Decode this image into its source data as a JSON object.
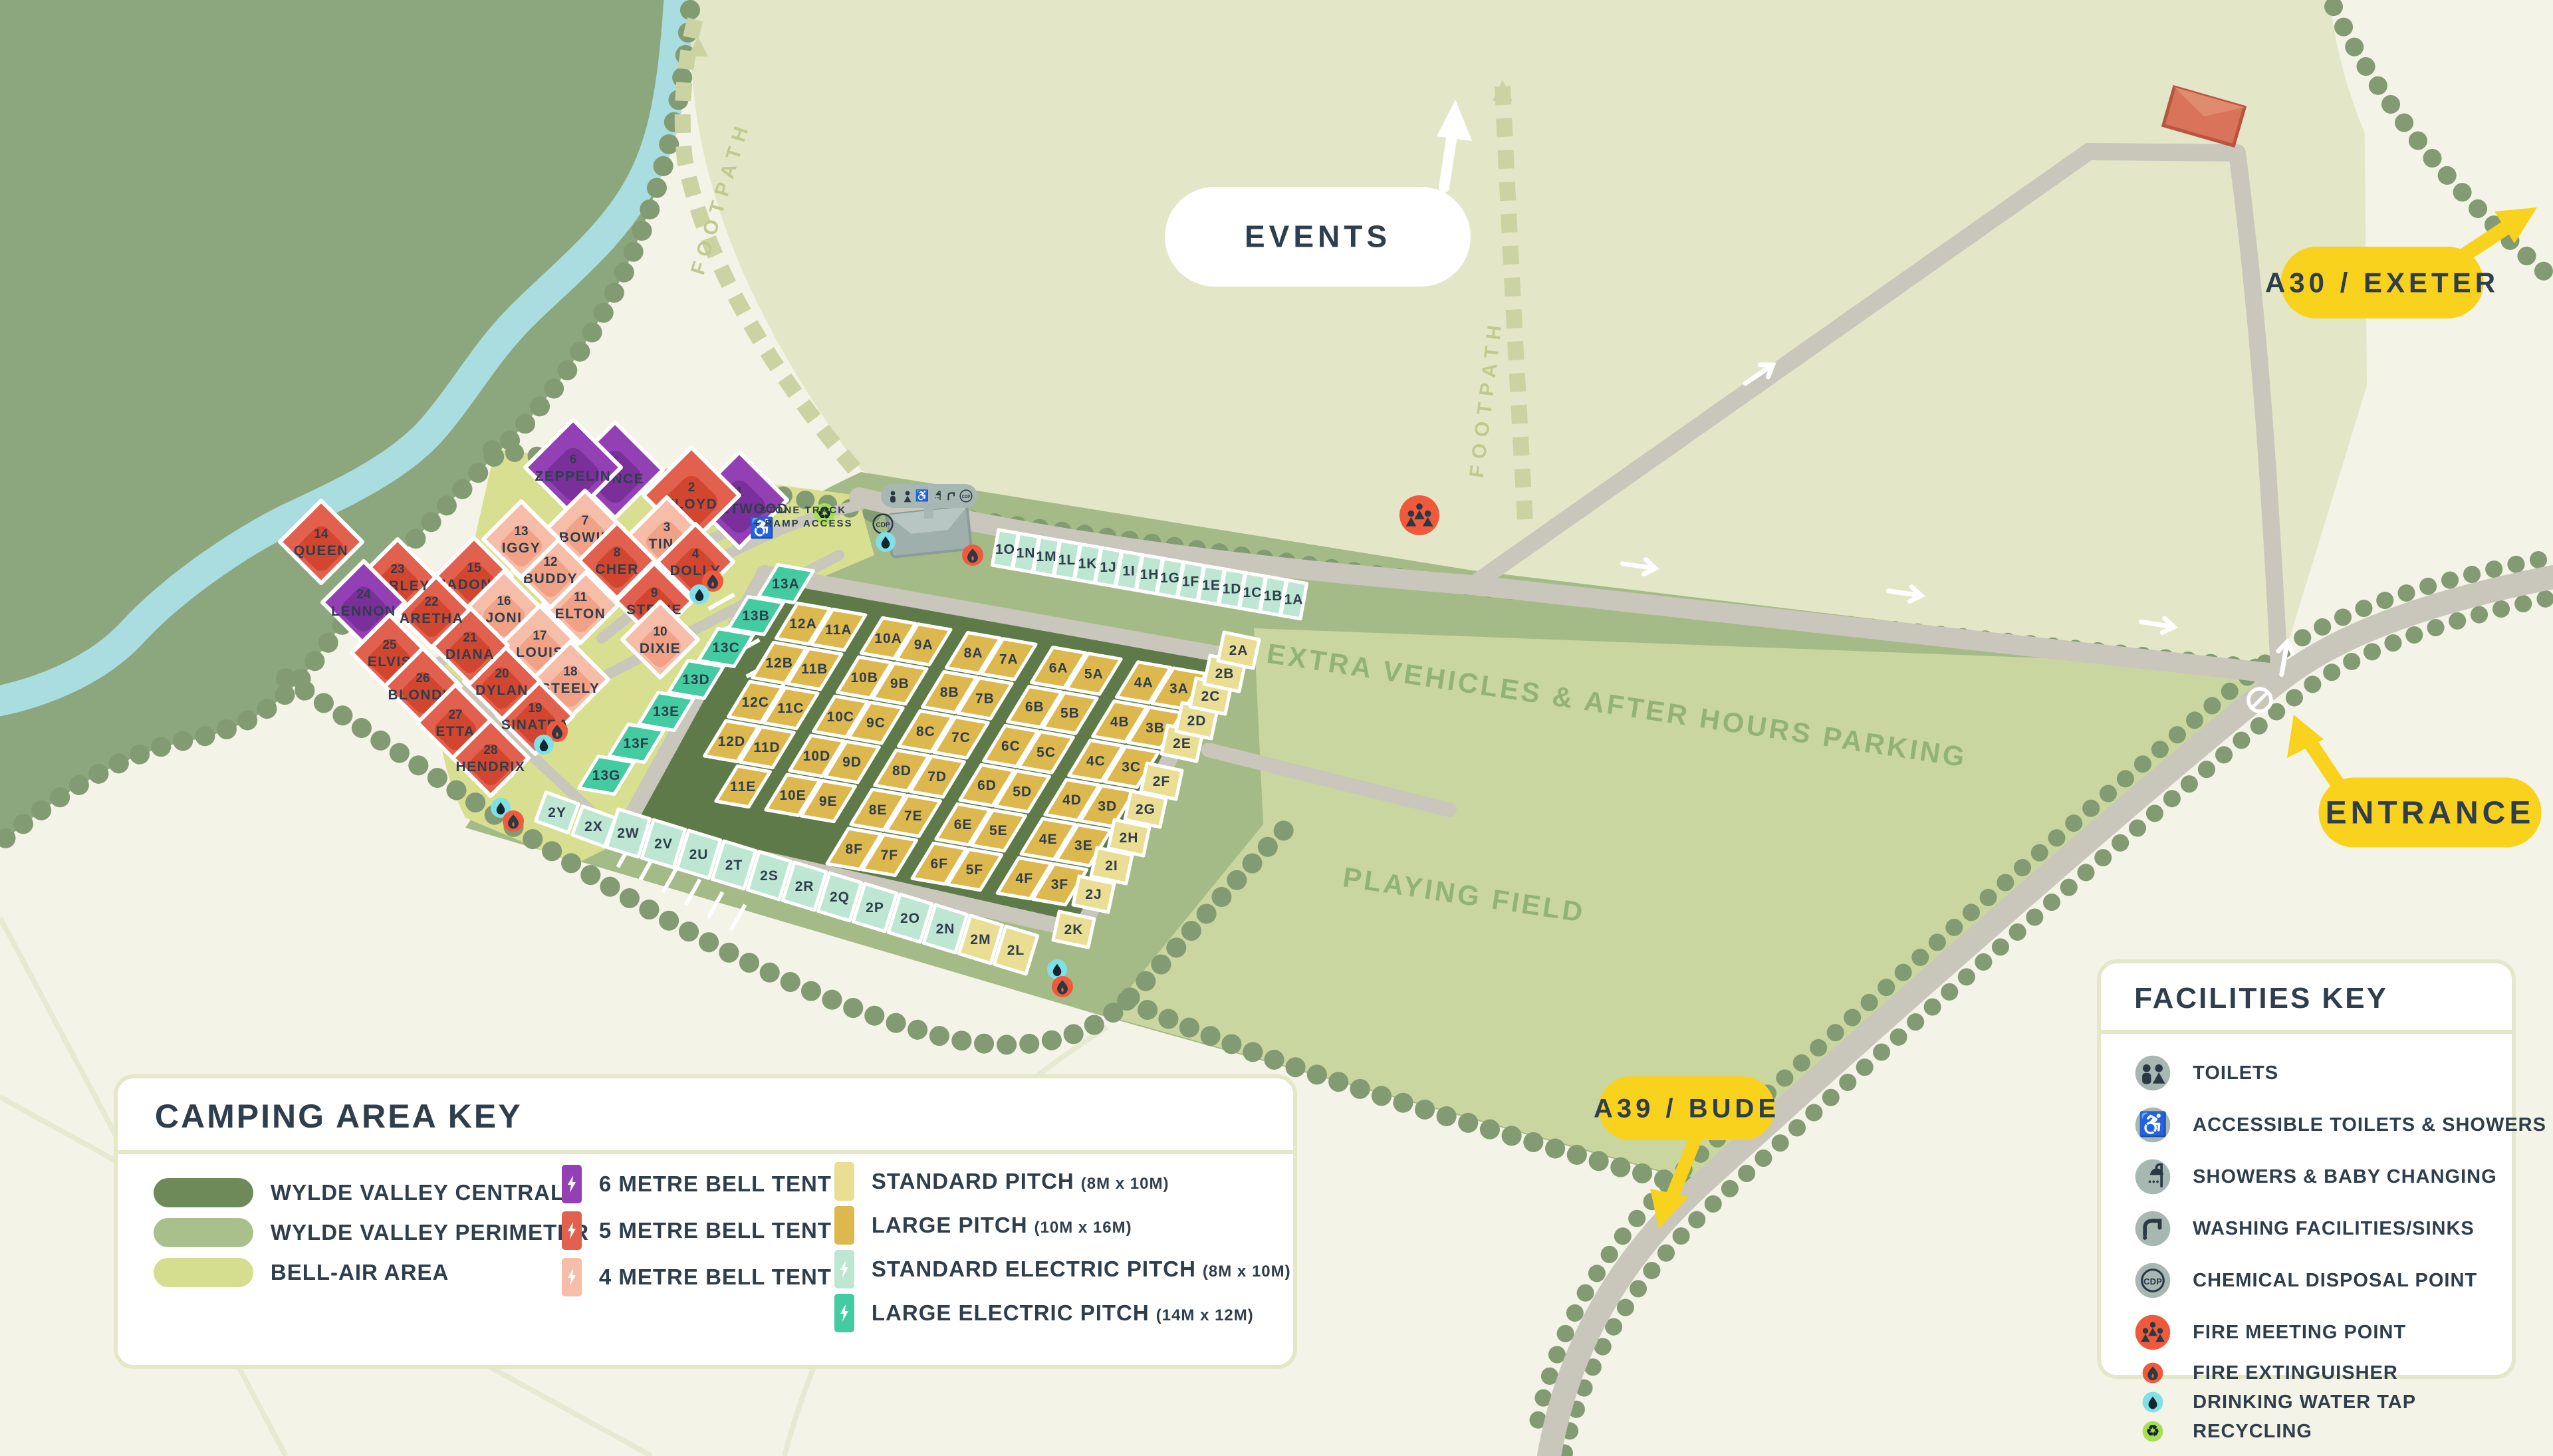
{
  "palette": {
    "cream": "#F4F3E7",
    "woodland": "#8CA77D",
    "events_field": "#E3E7C7",
    "perimeter": "#A4BB87",
    "playing": "#C9D6A0",
    "bellair": "#D9DF90",
    "central": "#5E7A48",
    "river": "#A9DDE0",
    "road": "#C9C6BB",
    "hedge": "#839B72",
    "navy": "#2F3E4C",
    "badge_yellow": "#F8D21C",
    "tent6": "#9440B5",
    "tent5": "#E2614E",
    "tent4": "#F6BDA9",
    "std": "#E9DE93",
    "large": "#DDB84E",
    "std_electric": "#BDE7D2",
    "large_electric": "#44CBA1",
    "fire": "#F05A3C",
    "water": "#7FE0E8",
    "recycle": "#A8DF52",
    "facility_gray": "#A7B7B2",
    "footpath": "#CBD3A2",
    "green_text": "#93B375"
  },
  "badges": {
    "events": {
      "label": "EVENTS"
    },
    "a30": {
      "label": "A30 / EXETER"
    },
    "entrance": {
      "label": "ENTRANCE"
    },
    "a39": {
      "label": "A39 / BUDE"
    }
  },
  "field_labels": {
    "parking": "EXTRA VEHICLES & AFTER HOURS PARKING",
    "playing": "PLAYING FIELD",
    "footpath": "FOOTPATH",
    "stone_track_1": "STONE TRACK",
    "stone_track_2": "+ RAMP ACCESS"
  },
  "camping_key": {
    "title": "CAMPING AREA KEY",
    "areas": [
      {
        "label": "WYLDE VALLEY CENTRAL",
        "color": "#6F8A59"
      },
      {
        "label": "WYLDE VALLEY PERIMETER",
        "color": "#A9C08D"
      },
      {
        "label": "BELL-AIR AREA",
        "color": "#D5DD8E"
      }
    ],
    "tents": [
      {
        "label": "6 METRE BELL TENT",
        "color": "#9440B5",
        "bolt": true
      },
      {
        "label": "5 METRE BELL TENT",
        "color": "#E2614E",
        "bolt": true
      },
      {
        "label": "4 METRE BELL TENT",
        "color": "#F6BDA9",
        "bolt": true
      }
    ],
    "pitches": [
      {
        "label": "STANDARD PITCH",
        "dims": "(8M x 10M)",
        "color": "#E9DE93",
        "bolt": false
      },
      {
        "label": "LARGE PITCH",
        "dims": "(10M x 16M)",
        "color": "#DDB84E",
        "bolt": false
      },
      {
        "label": "STANDARD ELECTRIC PITCH",
        "dims": "(8M x 10M)",
        "color": "#BDE7D2",
        "bolt": true
      },
      {
        "label": "LARGE ELECTRIC PITCH",
        "dims": "(14M x 12M)",
        "color": "#44CBA1",
        "bolt": true
      }
    ]
  },
  "facilities_key": {
    "title": "FACILITIES KEY",
    "items": [
      {
        "icon": "toilets",
        "label": "TOILETS",
        "size": "big"
      },
      {
        "icon": "accessible",
        "label": "ACCESSIBLE TOILETS & SHOWERS",
        "size": "big"
      },
      {
        "icon": "shower",
        "label": "SHOWERS & BABY CHANGING",
        "size": "big"
      },
      {
        "icon": "tap",
        "label": "WASHING FACILITIES/SINKS",
        "size": "big"
      },
      {
        "icon": "cdp",
        "label": "CHEMICAL DISPOSAL POINT",
        "size": "big"
      },
      {
        "icon": "fire_meeting",
        "label": "FIRE MEETING POINT",
        "size": "big"
      },
      {
        "icon": "fire_ext",
        "label": "FIRE EXTINGUISHER",
        "size": "small"
      },
      {
        "icon": "water",
        "label": "DRINKING WATER TAP",
        "size": "small"
      },
      {
        "icon": "recycling",
        "label": "RECYCLING",
        "size": "small"
      }
    ]
  },
  "map": {
    "bell_tents": [
      {
        "num": "1",
        "name": "FLEETWOOD",
        "type": "6m",
        "accessible": true
      },
      {
        "num": "2",
        "name": "FLOYD",
        "type": "5m"
      },
      {
        "num": "3",
        "name": "TINA",
        "type": "4m"
      },
      {
        "num": "4",
        "name": "DOLLY",
        "type": "5m"
      },
      {
        "num": "5",
        "name": "PRINCE",
        "type": "6m"
      },
      {
        "num": "6",
        "name": "ZEPPELIN",
        "type": "6m"
      },
      {
        "num": "7",
        "name": "BOWIE",
        "type": "4m"
      },
      {
        "num": "8",
        "name": "CHER",
        "type": "5m"
      },
      {
        "num": "9",
        "name": "STEVIE",
        "type": "5m"
      },
      {
        "num": "10",
        "name": "DIXIE",
        "type": "4m"
      },
      {
        "num": "11",
        "name": "ELTON",
        "type": "4m"
      },
      {
        "num": "12",
        "name": "BUDDY",
        "type": "4m"
      },
      {
        "num": "13",
        "name": "IGGY",
        "type": "4m"
      },
      {
        "num": "14",
        "name": "QUEEN",
        "type": "5m"
      },
      {
        "num": "15",
        "name": "MADONNA",
        "type": "5m"
      },
      {
        "num": "16",
        "name": "JONI",
        "type": "4m"
      },
      {
        "num": "17",
        "name": "LOUIS",
        "type": "4m"
      },
      {
        "num": "18",
        "name": "STEELY",
        "type": "4m"
      },
      {
        "num": "19",
        "name": "SINATRA",
        "type": "5m"
      },
      {
        "num": "20",
        "name": "DYLAN",
        "type": "5m"
      },
      {
        "num": "21",
        "name": "DIANA",
        "type": "5m"
      },
      {
        "num": "22",
        "name": "ARETHA",
        "type": "5m"
      },
      {
        "num": "23",
        "name": "MARLEY",
        "type": "5m"
      },
      {
        "num": "24",
        "name": "LENNON",
        "type": "6m"
      },
      {
        "num": "25",
        "name": "ELVIS",
        "type": "5m"
      },
      {
        "num": "26",
        "name": "BLONDIE",
        "type": "5m"
      },
      {
        "num": "27",
        "name": "ETTA",
        "type": "5m"
      },
      {
        "num": "28",
        "name": "HENDRIX",
        "type": "5m"
      }
    ],
    "large_pitches": {
      "cols": [
        "12",
        "11",
        "10",
        "9",
        "8",
        "7",
        "6",
        "5",
        "4",
        "3"
      ],
      "rows": [
        "A",
        "B",
        "C",
        "D",
        "E",
        "F"
      ],
      "skip": [
        "12E",
        "12F",
        "11F",
        "10F",
        "9F"
      ]
    },
    "electric_large": [
      "13A",
      "13B",
      "13C",
      "13D",
      "13E",
      "13F",
      "13G"
    ],
    "strips": {
      "top_electric": [
        "1O",
        "1N",
        "1M",
        "1L",
        "1K",
        "1J",
        "1I",
        "1H",
        "1G",
        "1F",
        "1E",
        "1D",
        "1C",
        "1B",
        "1A"
      ],
      "bottom_electric": [
        "2W",
        "2V",
        "2U",
        "2T",
        "2S",
        "2R",
        "2Q",
        "2P",
        "2O",
        "2N"
      ],
      "bottom_standard": [
        "2M",
        "2L"
      ],
      "right_standard": [
        "2K",
        "2J",
        "2I",
        "2H",
        "2G",
        "2F",
        "2E",
        "2D",
        "2C",
        "2B",
        "2A"
      ],
      "electric_pair": [
        "2Y",
        "2X"
      ]
    },
    "toilet_block_icons": [
      "male",
      "female",
      "accessible",
      "shower",
      "tap",
      "cdp"
    ]
  }
}
